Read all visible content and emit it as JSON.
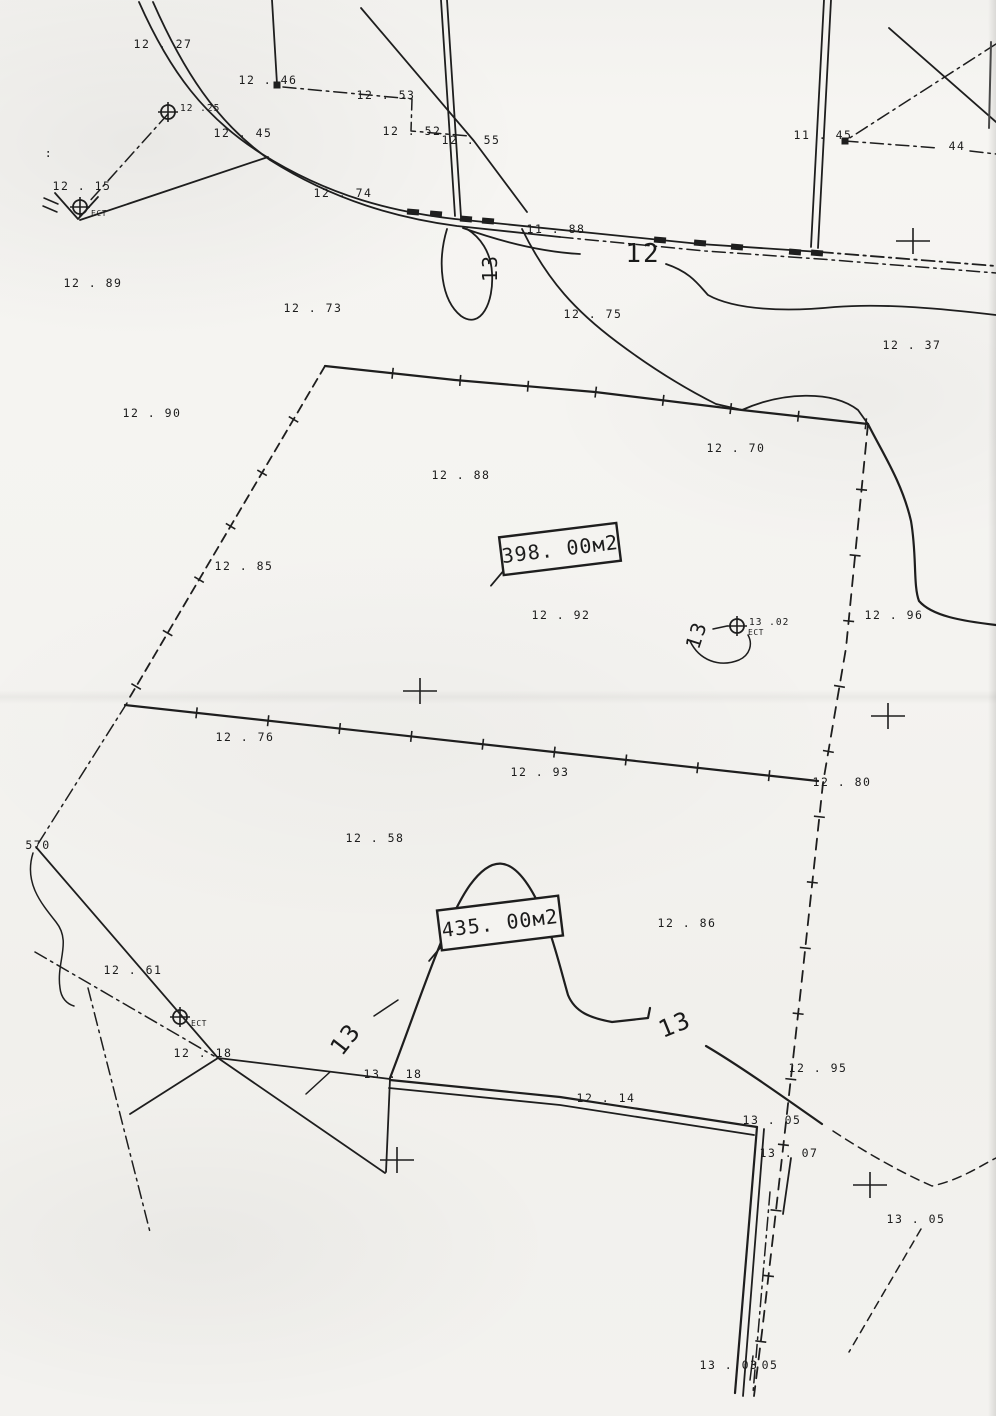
{
  "map": {
    "paper_color": "#f4f3f0",
    "ink_color": "#1e1e1e",
    "area_boxes": [
      {
        "label": "398. 00м2",
        "cx": 560,
        "cy": 549,
        "w": 118,
        "h": 38,
        "rot": -7
      },
      {
        "label": "435. 00м2",
        "cx": 500,
        "cy": 923,
        "w": 122,
        "h": 40,
        "rot": -7
      }
    ],
    "contour_labels": [
      {
        "text": "12",
        "x": 643,
        "y": 262,
        "rot": 0,
        "size": 26
      },
      {
        "text": "13",
        "x": 497,
        "y": 268,
        "rot": -90,
        "size": 20
      },
      {
        "text": "13",
        "x": 703,
        "y": 637,
        "rot": -72,
        "size": 20
      },
      {
        "text": "13",
        "x": 352,
        "y": 1044,
        "rot": -52,
        "size": 24
      },
      {
        "text": "13",
        "x": 678,
        "y": 1032,
        "rot": -22,
        "size": 24
      }
    ],
    "spot_heights": [
      {
        "text": "12 . 27",
        "x": 163,
        "y": 48
      },
      {
        "text": "12 . 46",
        "x": 268,
        "y": 84
      },
      {
        "text": "12 . 53",
        "x": 386,
        "y": 99
      },
      {
        "text": "12 . 52",
        "x": 412,
        "y": 135
      },
      {
        "text": "12 . 55",
        "x": 471,
        "y": 144
      },
      {
        "text": "11 . 45",
        "x": 823,
        "y": 139
      },
      {
        "text": "44",
        "x": 957,
        "y": 150
      },
      {
        "text": "12 . 45",
        "x": 243,
        "y": 137
      },
      {
        "text": "12 . 15",
        "x": 82,
        "y": 190
      },
      {
        "text": "12 . 74",
        "x": 343,
        "y": 197
      },
      {
        "text": "11 . 88",
        "x": 556,
        "y": 233
      },
      {
        "text": "12 . 89",
        "x": 93,
        "y": 287
      },
      {
        "text": "12 . 73",
        "x": 313,
        "y": 312
      },
      {
        "text": "12 . 75",
        "x": 593,
        "y": 318
      },
      {
        "text": "12 . 37",
        "x": 912,
        "y": 349
      },
      {
        "text": "12 . 90",
        "x": 152,
        "y": 417
      },
      {
        "text": "12 . 70",
        "x": 736,
        "y": 452
      },
      {
        "text": "12 . 88",
        "x": 461,
        "y": 479
      },
      {
        "text": "12 . 85",
        "x": 244,
        "y": 570
      },
      {
        "text": "12 . 92",
        "x": 561,
        "y": 619
      },
      {
        "text": "12 . 96",
        "x": 894,
        "y": 619
      },
      {
        "text": "12 . 76",
        "x": 245,
        "y": 741
      },
      {
        "text": "12 . 93",
        "x": 540,
        "y": 776
      },
      {
        "text": "12 . 80",
        "x": 842,
        "y": 786
      },
      {
        "text": "12 . 58",
        "x": 375,
        "y": 842
      },
      {
        "text": "570",
        "x": 38,
        "y": 849
      },
      {
        "text": "12 . 86",
        "x": 687,
        "y": 927
      },
      {
        "text": "12 . 61",
        "x": 133,
        "y": 974
      },
      {
        "text": "12 . 18",
        "x": 203,
        "y": 1057
      },
      {
        "text": "13 . 18",
        "x": 393,
        "y": 1078
      },
      {
        "text": "12 . 95",
        "x": 818,
        "y": 1072
      },
      {
        "text": "12 . 14",
        "x": 606,
        "y": 1102
      },
      {
        "text": "13 . 05",
        "x": 772,
        "y": 1124
      },
      {
        "text": "13 . 07",
        "x": 789,
        "y": 1157
      },
      {
        "text": "13 . 05",
        "x": 916,
        "y": 1223
      },
      {
        "text": "13 . 03",
        "x": 729,
        "y": 1369
      },
      {
        "text": "05",
        "x": 770,
        "y": 1369
      },
      {
        "text": ":",
        "x": 49,
        "y": 157
      }
    ],
    "station_markers": [
      {
        "x": 737,
        "y": 626,
        "label": "13 .02",
        "sub": "ЕСТ"
      },
      {
        "x": 180,
        "y": 1017,
        "label": "",
        "sub": "ЕСТ"
      },
      {
        "x": 168,
        "y": 112,
        "label": "12 .25",
        "sub": ""
      },
      {
        "x": 80,
        "y": 207,
        "label": "",
        "sub": "ЕСТ"
      }
    ],
    "crosses": [
      {
        "x": 913,
        "y": 241
      },
      {
        "x": 420,
        "y": 691
      },
      {
        "x": 888,
        "y": 716
      },
      {
        "x": 397,
        "y": 1160
      },
      {
        "x": 870,
        "y": 1185
      }
    ],
    "road_marks": [
      {
        "x": 413,
        "y": 212
      },
      {
        "x": 436,
        "y": 214
      },
      {
        "x": 466,
        "y": 219
      },
      {
        "x": 488,
        "y": 221
      },
      {
        "x": 660,
        "y": 240
      },
      {
        "x": 700,
        "y": 243
      },
      {
        "x": 737,
        "y": 247
      },
      {
        "x": 795,
        "y": 252
      },
      {
        "x": 817,
        "y": 253
      }
    ],
    "point_marks": [
      {
        "x": 845,
        "y": 141
      },
      {
        "x": 277,
        "y": 85
      }
    ]
  }
}
